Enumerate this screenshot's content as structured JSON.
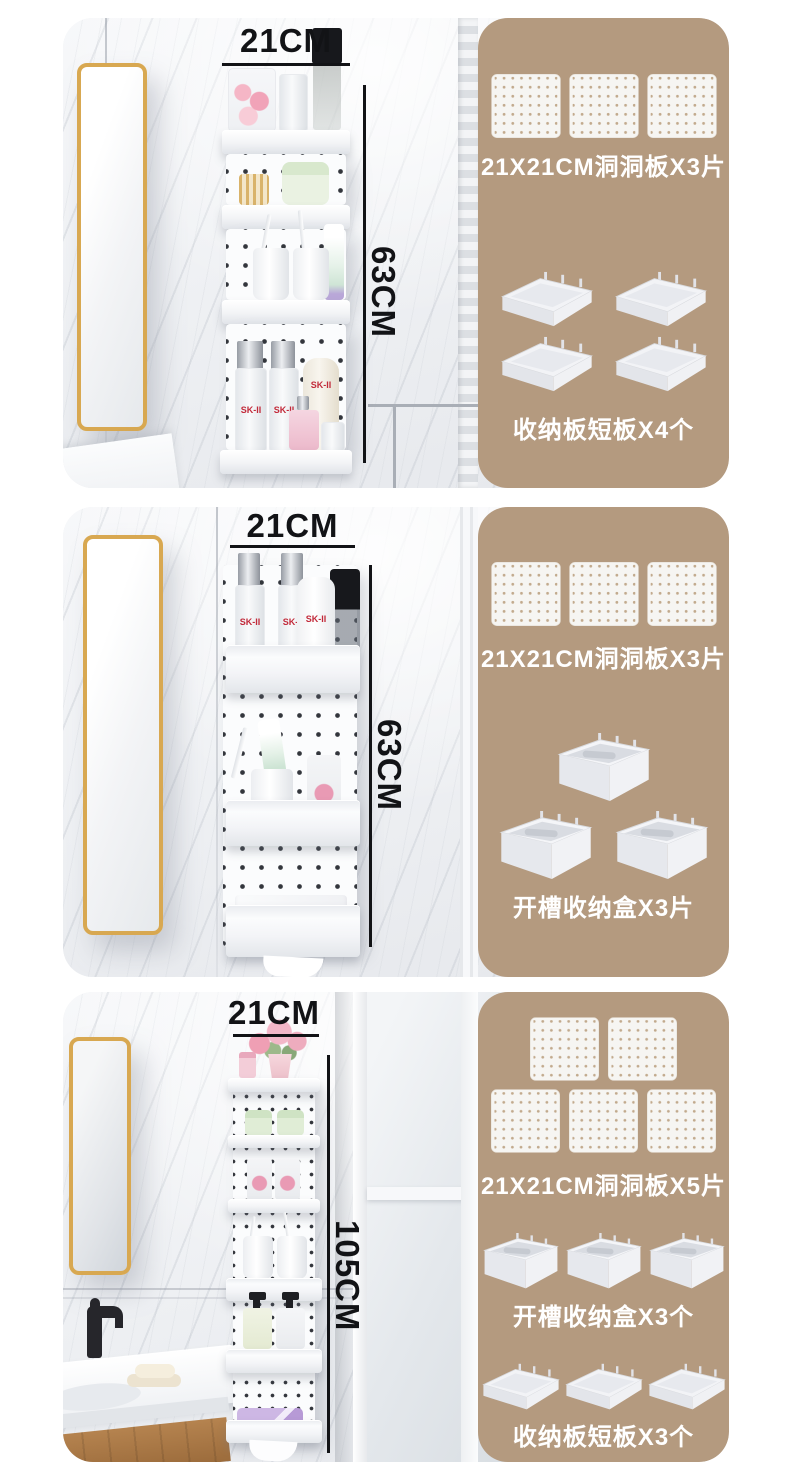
{
  "colors": {
    "kit_panel": "#b49a7f",
    "caption": "#ffffff",
    "dimension": "#121316",
    "mirror_frame": "#d8a851"
  },
  "sections": [
    {
      "photo": {
        "width_label": "21CM",
        "height_label": "63CM",
        "product_brand": "SK-II"
      },
      "kit": {
        "groups": [
          {
            "type": "pegboard",
            "count": 3,
            "rows": [
              3
            ],
            "caption": "21X21CM洞洞板X3片"
          },
          {
            "type": "tray",
            "count": 4,
            "rows": [
              2,
              2
            ],
            "caption": "收纳板短板X4个"
          }
        ]
      }
    },
    {
      "photo": {
        "width_label": "21CM",
        "height_label": "63CM",
        "product_brand": "SK-II"
      },
      "kit": {
        "groups": [
          {
            "type": "pegboard",
            "count": 3,
            "rows": [
              3
            ],
            "caption": "21X21CM洞洞板X3片"
          },
          {
            "type": "box",
            "count": 3,
            "rows": [
              1,
              2
            ],
            "caption": "开槽收纳盒X3片"
          }
        ]
      }
    },
    {
      "photo": {
        "width_label": "21CM",
        "height_label": "105CM"
      },
      "kit": {
        "groups": [
          {
            "type": "pegboard",
            "count": 5,
            "rows": [
              2,
              3
            ],
            "caption": "21X21CM洞洞板X5片"
          },
          {
            "type": "box",
            "count": 3,
            "rows": [
              3
            ],
            "caption": "开槽收纳盒X3个"
          },
          {
            "type": "tray",
            "count": 3,
            "rows": [
              3
            ],
            "caption": "收纳板短板X3个"
          }
        ]
      }
    }
  ]
}
